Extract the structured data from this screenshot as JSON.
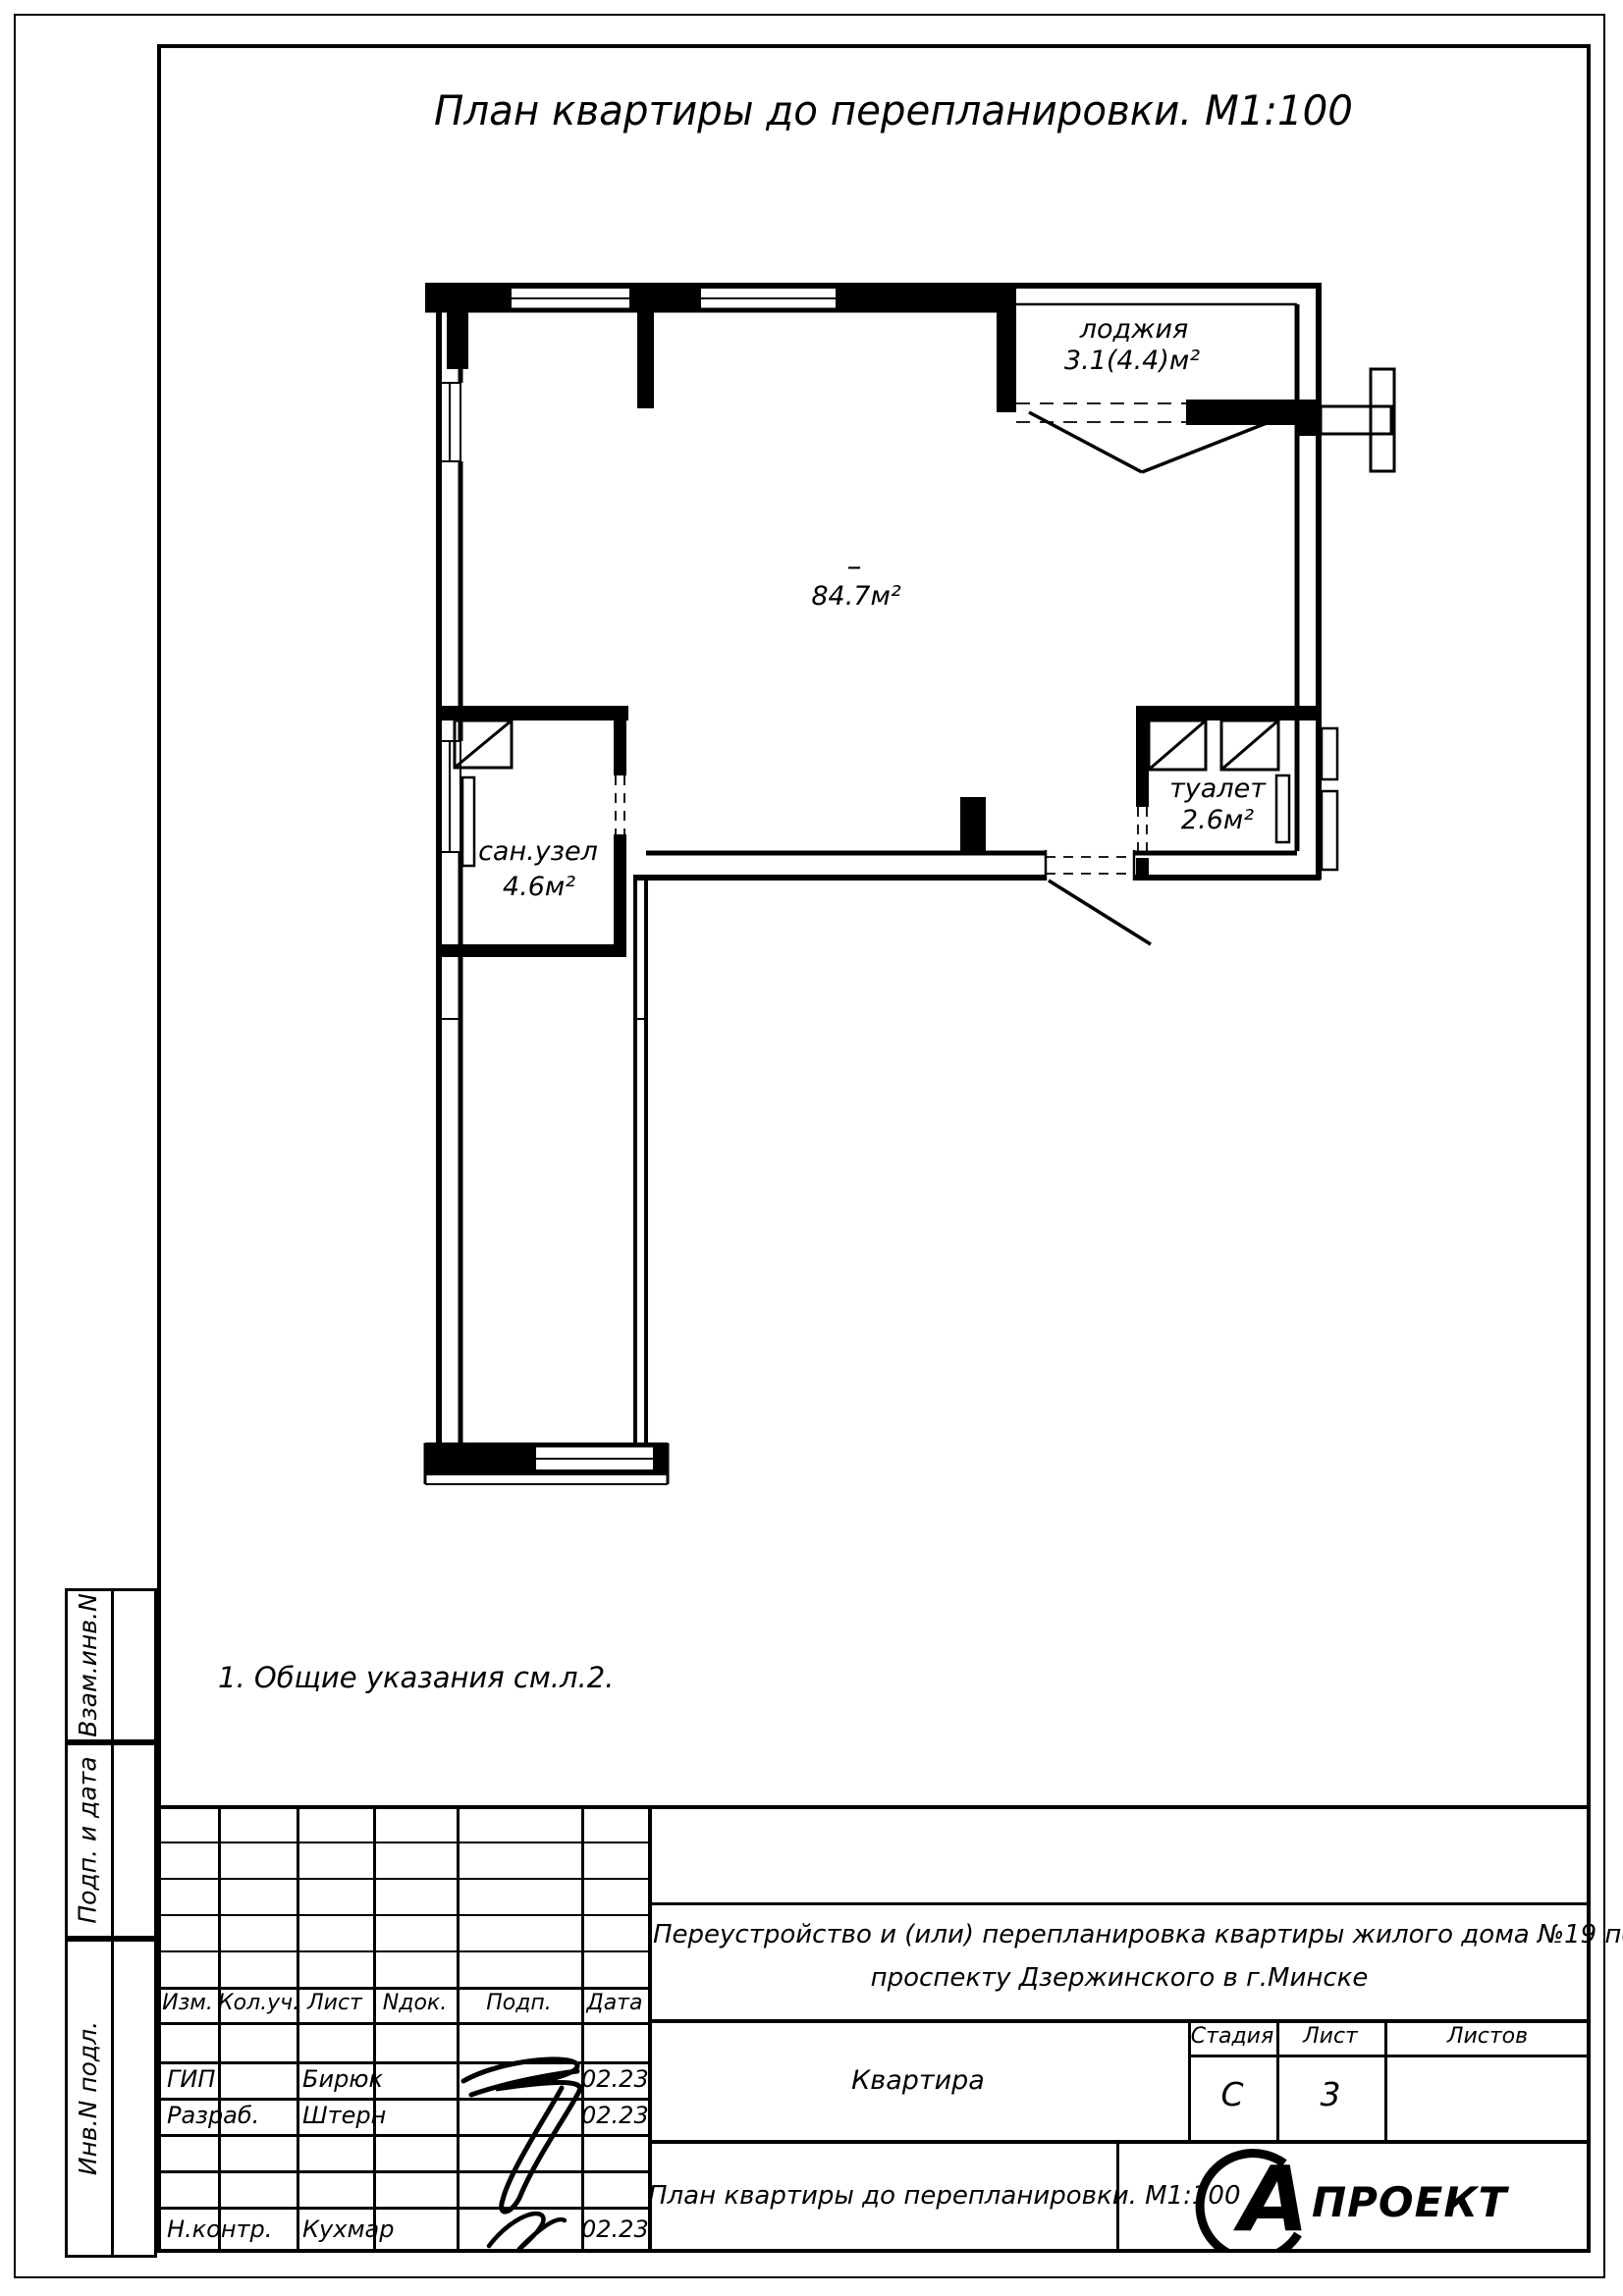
{
  "title": "План квартиры до перепланировки. М1:100",
  "note": "1. Общие указания см.л.2.",
  "plan": {
    "loggia_name": "лоджия",
    "loggia_area": "3.1(4.4)м²",
    "main_mark": "–",
    "main_area": "84.7м²",
    "toilet_name": "туалет",
    "toilet_area": "2.6м²",
    "bathroom_name": "сан.узел",
    "bathroom_area": "4.6м²"
  },
  "sidebar": {
    "box1": "Взам.инв.N",
    "box2": "Подп. и дата",
    "box3": "Инв.N подл."
  },
  "titleblock": {
    "cols": {
      "izm": "Изм.",
      "kol": "Кол.уч.",
      "list": "Лист",
      "ndok": "Nдок.",
      "podp": "Подп.",
      "data": "Дата"
    },
    "rows": [
      {
        "role": "ГИП",
        "name": "Бирюк",
        "date": "02.23"
      },
      {
        "role": "Разраб.",
        "name": "Штерн",
        "date": "02.23"
      },
      {
        "role": "Н.контр.",
        "name": "Кухмар",
        "date": "02.23"
      }
    ],
    "project_line1": "Переустройство и (или) перепланировка квартиры жилого дома №19 по",
    "project_line2": "проспекту Дзержинского в г.Минске",
    "object_name": "Квартира",
    "stage_label": "Стадия",
    "sheet_label": "Лист",
    "sheets_label": "Листов",
    "stage_value": "С",
    "sheet_value": "3",
    "sheets_value": "",
    "doc_title": "План квартиры до перепланировки. М1:100",
    "logo_letter": "А",
    "logo_text": "ПРОЕКТ"
  }
}
